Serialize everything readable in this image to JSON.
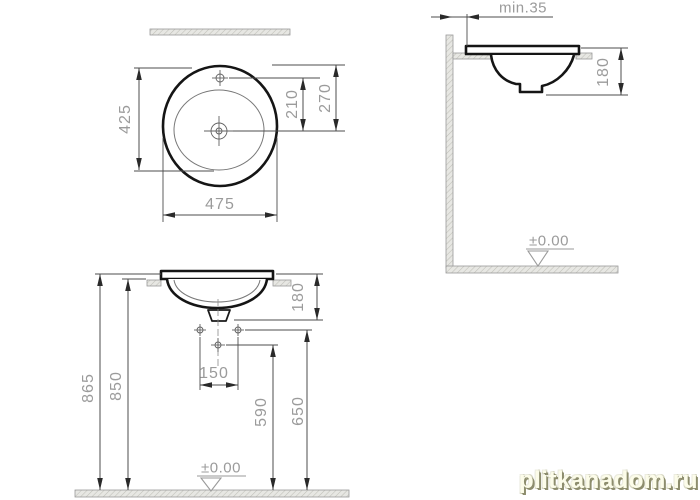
{
  "top_view": {
    "depth": "425",
    "width": "475",
    "tap_to_drain": "210",
    "edge_to_drain": "270"
  },
  "side_view": {
    "wall_clearance": "min.35",
    "bowl_depth": "180",
    "floor_level": "±0.00"
  },
  "front_view": {
    "total_height": "865",
    "counter_height": "850",
    "bowl_depth": "180",
    "tap_hole_spacing": "150",
    "drain_height": "590",
    "fixing_height": "650",
    "floor_level": "±0.00"
  },
  "watermark": "plitkanadom.ru",
  "colors": {
    "object_line": "#151515",
    "dimension_line": "#4d4d4d",
    "dimension_text": "#9b9b9b",
    "hatch_fill": "#e7e7e3",
    "watermark_text": "#fcfce9",
    "watermark_shadow": "#8d8d6d"
  }
}
